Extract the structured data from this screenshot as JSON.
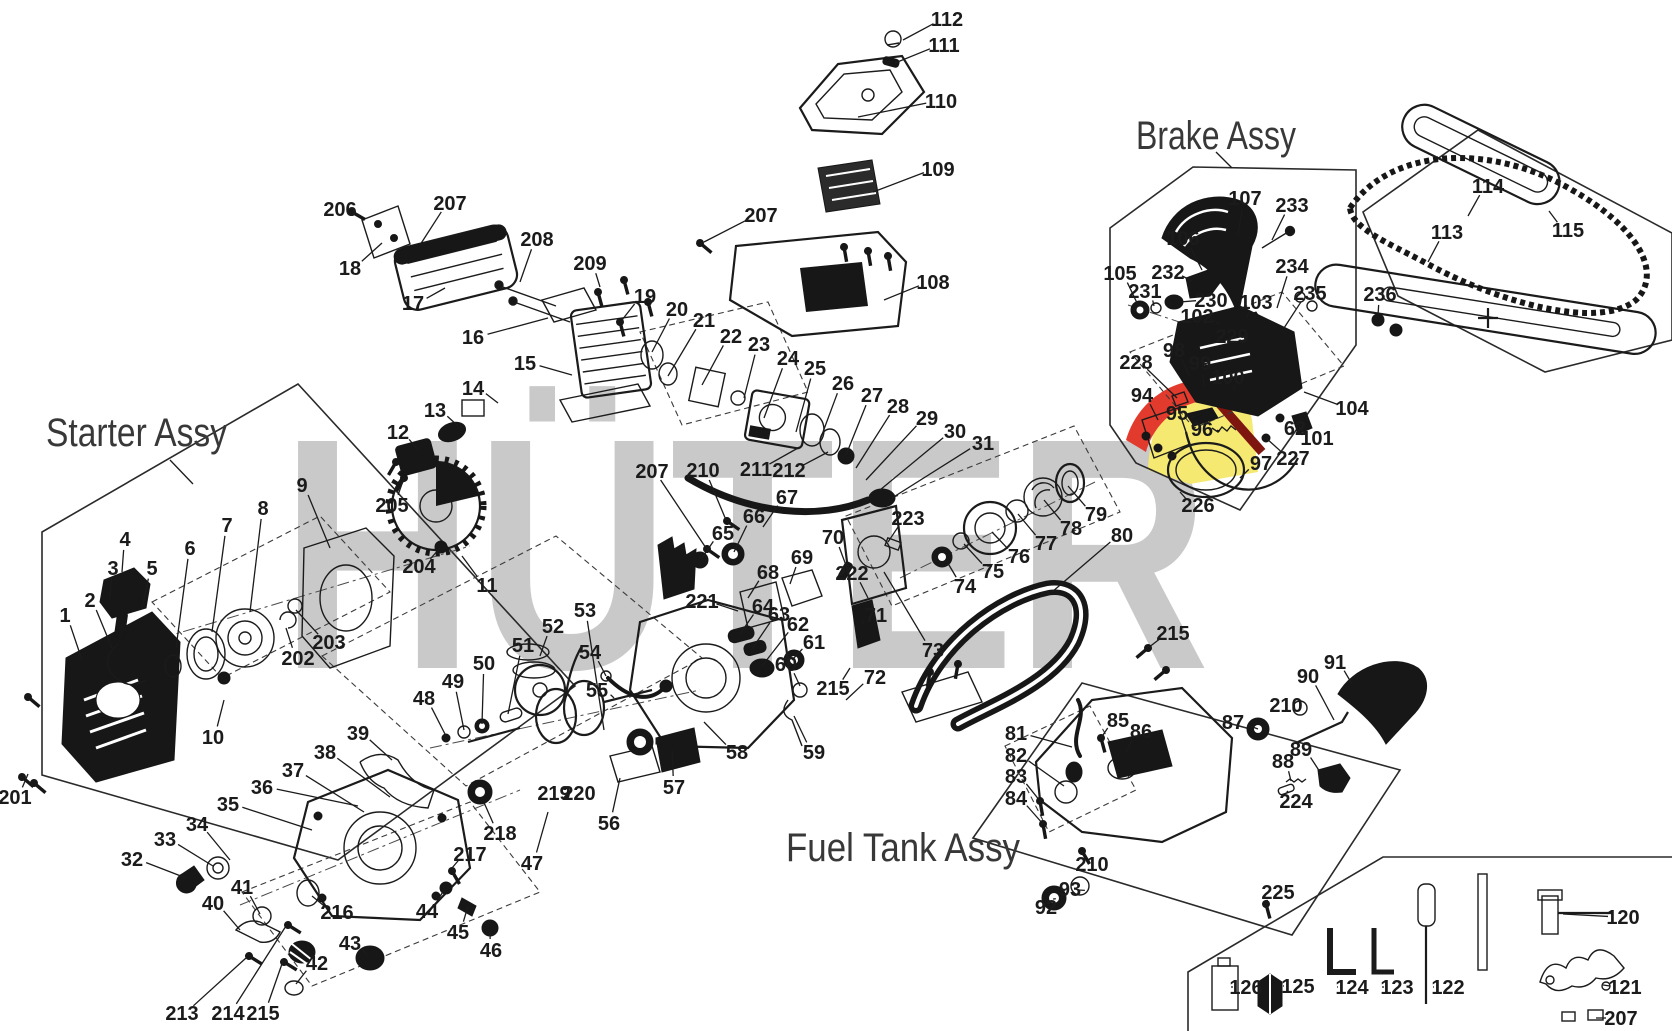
{
  "figure": {
    "kind": "exploded-parts-diagram",
    "product": "chainsaw"
  },
  "watermark": {
    "text": "HÜTER",
    "color": "#c9c9c9",
    "logo_red": "#e23b2e",
    "logo_dark_red": "#7e150e",
    "logo_yellow": "#f6e972"
  },
  "assembly_titles": [
    {
      "label": "Starter Assy",
      "x": 46,
      "y": 446,
      "width": 181,
      "leader": [
        [
          170,
          460
        ],
        [
          193,
          484
        ]
      ]
    },
    {
      "label": "Brake Assy",
      "x": 1136,
      "y": 149,
      "width": 160,
      "leader": [
        [
          1216,
          152
        ],
        [
          1232,
          168
        ]
      ]
    },
    {
      "label": "Fuel Tank Assy",
      "x": 786,
      "y": 861,
      "width": 234,
      "leader": null
    }
  ],
  "callouts": [
    {
      "t": "112",
      "x": 947,
      "y": 19,
      "e": [
        903,
        40
      ]
    },
    {
      "t": "111",
      "x": 944,
      "y": 45,
      "e": [
        895,
        63
      ]
    },
    {
      "t": "110",
      "x": 941,
      "y": 101,
      "e": [
        858,
        117
      ]
    },
    {
      "t": "109",
      "x": 938,
      "y": 169,
      "e": [
        873,
        192
      ]
    },
    {
      "t": "207",
      "x": 761,
      "y": 215,
      "e": [
        704,
        242
      ]
    },
    {
      "t": "108",
      "x": 933,
      "y": 282,
      "e": [
        884,
        300
      ]
    },
    {
      "t": "206",
      "x": 340,
      "y": 209,
      "e": [
        360,
        216
      ]
    },
    {
      "t": "207",
      "x": 450,
      "y": 203,
      "e": [
        420,
        245
      ]
    },
    {
      "t": "18",
      "x": 350,
      "y": 268,
      "e": [
        382,
        243
      ]
    },
    {
      "t": "17",
      "x": 413,
      "y": 303,
      "e": [
        445,
        288
      ]
    },
    {
      "t": "208",
      "x": 537,
      "y": 239,
      "e": [
        520,
        282
      ]
    },
    {
      "t": "16",
      "x": 473,
      "y": 337,
      "e": [
        548,
        318
      ]
    },
    {
      "t": "209",
      "x": 590,
      "y": 263,
      "e": [
        600,
        287
      ]
    },
    {
      "t": "19",
      "x": 645,
      "y": 296,
      "e": [
        622,
        320
      ]
    },
    {
      "t": "15",
      "x": 525,
      "y": 363,
      "e": [
        572,
        375
      ]
    },
    {
      "t": "14",
      "x": 473,
      "y": 388,
      "e": [
        498,
        403
      ]
    },
    {
      "t": "13",
      "x": 435,
      "y": 410,
      "e": [
        458,
        426
      ]
    },
    {
      "t": "12",
      "x": 398,
      "y": 432,
      "e": [
        418,
        450
      ]
    },
    {
      "t": "205",
      "x": 392,
      "y": 505,
      "e": [
        404,
        478
      ]
    },
    {
      "t": "204",
      "x": 419,
      "y": 566,
      "e": [
        440,
        548
      ]
    },
    {
      "t": "11",
      "x": 487,
      "y": 585,
      "e": [
        462,
        556
      ]
    },
    {
      "t": "20",
      "x": 677,
      "y": 309,
      "e": [
        652,
        352
      ]
    },
    {
      "t": "21",
      "x": 704,
      "y": 320,
      "e": [
        668,
        376
      ]
    },
    {
      "t": "22",
      "x": 731,
      "y": 336,
      "e": [
        702,
        385
      ]
    },
    {
      "t": "23",
      "x": 759,
      "y": 344,
      "e": [
        744,
        398
      ]
    },
    {
      "t": "24",
      "x": 788,
      "y": 358,
      "e": [
        764,
        418
      ]
    },
    {
      "t": "25",
      "x": 815,
      "y": 368,
      "e": [
        796,
        432
      ]
    },
    {
      "t": "26",
      "x": 843,
      "y": 383,
      "e": [
        820,
        440
      ]
    },
    {
      "t": "27",
      "x": 872,
      "y": 395,
      "e": [
        846,
        455
      ]
    },
    {
      "t": "28",
      "x": 898,
      "y": 406,
      "e": [
        856,
        468
      ]
    },
    {
      "t": "29",
      "x": 927,
      "y": 418,
      "e": [
        866,
        480
      ]
    },
    {
      "t": "30",
      "x": 955,
      "y": 431,
      "e": [
        880,
        490
      ]
    },
    {
      "t": "31",
      "x": 983,
      "y": 443,
      "e": [
        892,
        498
      ]
    },
    {
      "t": "207",
      "x": 652,
      "y": 471,
      "e": [
        706,
        548
      ]
    },
    {
      "t": "210",
      "x": 703,
      "y": 470,
      "e": [
        726,
        520
      ]
    },
    {
      "t": "211",
      "x": 756,
      "y": 469,
      "e": [
        798,
        448
      ]
    },
    {
      "t": "212",
      "x": 789,
      "y": 470,
      "e": [
        828,
        452
      ]
    },
    {
      "t": "65",
      "x": 723,
      "y": 533,
      "e": [
        702,
        558
      ]
    },
    {
      "t": "66",
      "x": 754,
      "y": 516,
      "e": [
        734,
        552
      ]
    },
    {
      "t": "67",
      "x": 787,
      "y": 497,
      "e": [
        763,
        527
      ]
    },
    {
      "t": "68",
      "x": 768,
      "y": 572,
      "e": [
        748,
        598
      ]
    },
    {
      "t": "69",
      "x": 802,
      "y": 557,
      "e": [
        790,
        584
      ]
    },
    {
      "t": "70",
      "x": 833,
      "y": 537,
      "e": [
        847,
        568
      ]
    },
    {
      "t": "221",
      "x": 702,
      "y": 601,
      "e": [
        738,
        611
      ]
    },
    {
      "t": "64",
      "x": 763,
      "y": 606,
      "e": [
        740,
        634
      ]
    },
    {
      "t": "63",
      "x": 779,
      "y": 614,
      "e": [
        752,
        649
      ]
    },
    {
      "t": "62",
      "x": 798,
      "y": 624,
      "e": [
        762,
        666
      ]
    },
    {
      "t": "61",
      "x": 814,
      "y": 642,
      "e": [
        792,
        660
      ]
    },
    {
      "t": "222",
      "x": 852,
      "y": 573,
      "e": [
        868,
        598
      ]
    },
    {
      "t": "71",
      "x": 876,
      "y": 615,
      "e": [
        862,
        624
      ]
    },
    {
      "t": "60",
      "x": 786,
      "y": 664,
      "e": [
        800,
        686
      ]
    },
    {
      "t": "215",
      "x": 833,
      "y": 688,
      "e": [
        850,
        668
      ]
    },
    {
      "t": "72",
      "x": 875,
      "y": 677,
      "e": [
        846,
        700
      ]
    },
    {
      "t": "73",
      "x": 933,
      "y": 650,
      "e": [
        884,
        572
      ]
    },
    {
      "t": "223",
      "x": 908,
      "y": 518,
      "e": [
        888,
        542
      ]
    },
    {
      "t": "74",
      "x": 965,
      "y": 586,
      "e": [
        946,
        560
      ]
    },
    {
      "t": "75",
      "x": 993,
      "y": 571,
      "e": [
        964,
        544
      ]
    },
    {
      "t": "76",
      "x": 1019,
      "y": 556,
      "e": [
        992,
        532
      ]
    },
    {
      "t": "77",
      "x": 1046,
      "y": 543,
      "e": [
        1018,
        514
      ]
    },
    {
      "t": "78",
      "x": 1071,
      "y": 528,
      "e": [
        1044,
        500
      ]
    },
    {
      "t": "79",
      "x": 1096,
      "y": 514,
      "e": [
        1068,
        486
      ]
    },
    {
      "t": "80",
      "x": 1122,
      "y": 535,
      "e": [
        1052,
        592
      ]
    },
    {
      "t": "48",
      "x": 424,
      "y": 698,
      "e": [
        446,
        736
      ]
    },
    {
      "t": "49",
      "x": 453,
      "y": 681,
      "e": [
        464,
        730
      ]
    },
    {
      "t": "50",
      "x": 484,
      "y": 663,
      "e": [
        482,
        724
      ]
    },
    {
      "t": "51",
      "x": 523,
      "y": 645,
      "e": [
        508,
        714
      ]
    },
    {
      "t": "52",
      "x": 553,
      "y": 626,
      "e": [
        540,
        656
      ]
    },
    {
      "t": "53",
      "x": 585,
      "y": 610,
      "e": [
        604,
        730
      ]
    },
    {
      "t": "54",
      "x": 590,
      "y": 652,
      "e": [
        606,
        676
      ]
    },
    {
      "t": "55",
      "x": 597,
      "y": 690,
      "e": [
        614,
        698
      ]
    },
    {
      "t": "39",
      "x": 358,
      "y": 733,
      "e": [
        392,
        760
      ]
    },
    {
      "t": "38",
      "x": 325,
      "y": 752,
      "e": [
        390,
        797
      ]
    },
    {
      "t": "37",
      "x": 293,
      "y": 770,
      "e": [
        364,
        812
      ]
    },
    {
      "t": "36",
      "x": 262,
      "y": 787,
      "e": [
        358,
        806
      ]
    },
    {
      "t": "35",
      "x": 228,
      "y": 804,
      "e": [
        312,
        830
      ]
    },
    {
      "t": "34",
      "x": 197,
      "y": 824,
      "e": [
        230,
        860
      ]
    },
    {
      "t": "33",
      "x": 165,
      "y": 839,
      "e": [
        213,
        866
      ]
    },
    {
      "t": "32",
      "x": 132,
      "y": 859,
      "e": [
        186,
        878
      ]
    },
    {
      "t": "41",
      "x": 242,
      "y": 887,
      "e": [
        260,
        914
      ]
    },
    {
      "t": "40",
      "x": 213,
      "y": 903,
      "e": [
        240,
        930
      ]
    },
    {
      "t": "216",
      "x": 337,
      "y": 912,
      "e": [
        312,
        896
      ]
    },
    {
      "t": "43",
      "x": 350,
      "y": 943,
      "e": [
        368,
        956
      ]
    },
    {
      "t": "42",
      "x": 317,
      "y": 963,
      "e": [
        296,
        984
      ]
    },
    {
      "t": "213",
      "x": 182,
      "y": 1013,
      "e": [
        246,
        958
      ]
    },
    {
      "t": "214",
      "x": 228,
      "y": 1013,
      "e": [
        286,
        926
      ]
    },
    {
      "t": "215",
      "x": 263,
      "y": 1013,
      "e": [
        283,
        961
      ]
    },
    {
      "t": "217",
      "x": 470,
      "y": 854,
      "e": [
        452,
        868
      ]
    },
    {
      "t": "44",
      "x": 427,
      "y": 911,
      "e": [
        444,
        890
      ]
    },
    {
      "t": "45",
      "x": 458,
      "y": 932,
      "e": [
        468,
        906
      ]
    },
    {
      "t": "46",
      "x": 491,
      "y": 950,
      "e": [
        490,
        932
      ]
    },
    {
      "t": "47",
      "x": 532,
      "y": 863,
      "e": [
        548,
        812
      ]
    },
    {
      "t": "218",
      "x": 500,
      "y": 833,
      "e": [
        482,
        798
      ]
    },
    {
      "t": "219",
      "x": 554,
      "y": 793,
      "e": [
        565,
        799
      ]
    },
    {
      "t": "220",
      "x": 579,
      "y": 793,
      "e": [
        570,
        799
      ]
    },
    {
      "t": "56",
      "x": 609,
      "y": 823,
      "e": [
        620,
        778
      ]
    },
    {
      "t": "57",
      "x": 674,
      "y": 787,
      "e": [
        672,
        750
      ]
    },
    {
      "t": "58",
      "x": 737,
      "y": 752,
      "e": [
        704,
        722
      ]
    },
    {
      "t": "59",
      "x": 814,
      "y": 752,
      "e": [
        794,
        716
      ]
    },
    {
      "t": "81",
      "x": 1016,
      "y": 733,
      "e": [
        1072,
        747
      ]
    },
    {
      "t": "82",
      "x": 1016,
      "y": 755,
      "e": [
        1064,
        786
      ]
    },
    {
      "t": "83",
      "x": 1016,
      "y": 776,
      "e": [
        1040,
        801
      ]
    },
    {
      "t": "84",
      "x": 1016,
      "y": 798,
      "e": [
        1043,
        824
      ]
    },
    {
      "t": "85",
      "x": 1118,
      "y": 720,
      "e": [
        1101,
        738
      ]
    },
    {
      "t": "86",
      "x": 1141,
      "y": 731,
      "e": [
        1126,
        752
      ]
    },
    {
      "t": "210",
      "x": 1092,
      "y": 864,
      "e": [
        1082,
        851
      ]
    },
    {
      "t": "92",
      "x": 1046,
      "y": 907,
      "e": [
        1053,
        899
      ]
    },
    {
      "t": "93",
      "x": 1070,
      "y": 889,
      "e": [
        1078,
        890
      ]
    },
    {
      "t": "225",
      "x": 1278,
      "y": 892,
      "e": [
        1266,
        904
      ]
    },
    {
      "t": "87",
      "x": 1233,
      "y": 722,
      "e": [
        1258,
        729
      ]
    },
    {
      "t": "88",
      "x": 1283,
      "y": 761,
      "e": [
        1291,
        781
      ]
    },
    {
      "t": "89",
      "x": 1301,
      "y": 749,
      "e": [
        1320,
        772
      ]
    },
    {
      "t": "90",
      "x": 1308,
      "y": 676,
      "e": [
        1334,
        720
      ]
    },
    {
      "t": "91",
      "x": 1335,
      "y": 662,
      "e": [
        1352,
        684
      ]
    },
    {
      "t": "210",
      "x": 1286,
      "y": 705,
      "e": [
        1300,
        708
      ]
    },
    {
      "t": "224",
      "x": 1296,
      "y": 801,
      "e": [
        1288,
        791
      ]
    },
    {
      "t": "215",
      "x": 1173,
      "y": 633,
      "e": [
        1148,
        648
      ]
    },
    {
      "t": "105",
      "x": 1120,
      "y": 273,
      "e": [
        1138,
        305
      ]
    },
    {
      "t": "231",
      "x": 1145,
      "y": 291,
      "e": [
        1154,
        306
      ]
    },
    {
      "t": "232",
      "x": 1168,
      "y": 272,
      "e": [
        1192,
        281
      ]
    },
    {
      "t": "230",
      "x": 1211,
      "y": 300,
      "e": [
        1180,
        302
      ]
    },
    {
      "t": "102",
      "x": 1197,
      "y": 316,
      "e": [
        1220,
        324
      ]
    },
    {
      "t": "103",
      "x": 1256,
      "y": 302,
      "e": [
        1247,
        318
      ]
    },
    {
      "t": "229",
      "x": 1232,
      "y": 336,
      "e": [
        1218,
        342
      ]
    },
    {
      "t": "234",
      "x": 1292,
      "y": 266,
      "e": [
        1277,
        308
      ]
    },
    {
      "t": "235",
      "x": 1310,
      "y": 293,
      "e": [
        1284,
        328
      ]
    },
    {
      "t": "233",
      "x": 1292,
      "y": 205,
      "e": [
        1272,
        240
      ]
    },
    {
      "t": "107",
      "x": 1245,
      "y": 198,
      "e": [
        1238,
        235
      ]
    },
    {
      "t": "106",
      "x": 1183,
      "y": 238,
      "e": [
        1202,
        270
      ]
    },
    {
      "t": "98",
      "x": 1174,
      "y": 350,
      "e": [
        1190,
        377
      ]
    },
    {
      "t": "99",
      "x": 1200,
      "y": 363,
      "e": [
        1204,
        386
      ]
    },
    {
      "t": "100",
      "x": 1228,
      "y": 377,
      "e": [
        1234,
        390
      ]
    },
    {
      "t": "228",
      "x": 1136,
      "y": 362,
      "e": [
        1177,
        398
      ]
    },
    {
      "t": "94",
      "x": 1142,
      "y": 395,
      "e": [
        1158,
        420
      ]
    },
    {
      "t": "95",
      "x": 1177,
      "y": 413,
      "e": [
        1194,
        417
      ]
    },
    {
      "t": "96",
      "x": 1202,
      "y": 429,
      "e": [
        1220,
        431
      ]
    },
    {
      "t": "97",
      "x": 1261,
      "y": 463,
      "e": [
        1240,
        478
      ]
    },
    {
      "t": "227",
      "x": 1293,
      "y": 458,
      "e": [
        1266,
        438
      ]
    },
    {
      "t": "62",
      "x": 1295,
      "y": 428,
      "e": [
        1280,
        418
      ]
    },
    {
      "t": "226",
      "x": 1198,
      "y": 505,
      "e": [
        1180,
        492
      ]
    },
    {
      "t": "101",
      "x": 1317,
      "y": 438,
      "e": [
        1299,
        427
      ]
    },
    {
      "t": "104",
      "x": 1352,
      "y": 408,
      "e": [
        1304,
        392
      ]
    },
    {
      "t": "113",
      "x": 1447,
      "y": 232,
      "e": [
        1428,
        262
      ]
    },
    {
      "t": "114",
      "x": 1488,
      "y": 186,
      "e": [
        1468,
        216
      ]
    },
    {
      "t": "115",
      "x": 1568,
      "y": 230,
      "e": [
        1549,
        211
      ]
    },
    {
      "t": "236",
      "x": 1380,
      "y": 294,
      "e": [
        1378,
        316
      ]
    },
    {
      "t": "126",
      "x": 1246,
      "y": 987,
      "e": [
        1233,
        987
      ]
    },
    {
      "t": "125",
      "x": 1298,
      "y": 986,
      "e": [
        1284,
        986
      ]
    },
    {
      "t": "124",
      "x": 1352,
      "y": 987,
      "e": [
        1338,
        987
      ]
    },
    {
      "t": "123",
      "x": 1397,
      "y": 987,
      "e": [
        1384,
        987
      ]
    },
    {
      "t": "122",
      "x": 1448,
      "y": 987,
      "e": [
        1434,
        987
      ]
    },
    {
      "t": "121",
      "x": 1625,
      "y": 987,
      "e": [
        1603,
        985
      ]
    },
    {
      "t": "120",
      "x": 1623,
      "y": 917,
      "e": [
        1563,
        914
      ]
    },
    {
      "t": "207",
      "x": 1621,
      "y": 1018,
      "e": [
        1596,
        1018
      ]
    },
    {
      "t": "9",
      "x": 302,
      "y": 485,
      "e": [
        330,
        548
      ]
    },
    {
      "t": "8",
      "x": 263,
      "y": 508,
      "e": [
        250,
        612
      ]
    },
    {
      "t": "7",
      "x": 227,
      "y": 525,
      "e": [
        212,
        632
      ]
    },
    {
      "t": "6",
      "x": 190,
      "y": 548,
      "e": [
        176,
        648
      ]
    },
    {
      "t": "5",
      "x": 152,
      "y": 568,
      "e": [
        142,
        608
      ]
    },
    {
      "t": "4",
      "x": 125,
      "y": 539,
      "e": [
        122,
        572
      ]
    },
    {
      "t": "3",
      "x": 113,
      "y": 568,
      "e": [
        110,
        598
      ]
    },
    {
      "t": "2",
      "x": 90,
      "y": 600,
      "e": [
        112,
        648
      ]
    },
    {
      "t": "1",
      "x": 65,
      "y": 615,
      "e": [
        82,
        660
      ]
    },
    {
      "t": "10",
      "x": 213,
      "y": 737,
      "e": [
        224,
        700
      ]
    },
    {
      "t": "202",
      "x": 298,
      "y": 658,
      "e": [
        286,
        628
      ]
    },
    {
      "t": "203",
      "x": 329,
      "y": 642,
      "e": [
        296,
        610
      ]
    },
    {
      "t": "201",
      "x": 15,
      "y": 797,
      "e": [
        28,
        774
      ]
    }
  ]
}
